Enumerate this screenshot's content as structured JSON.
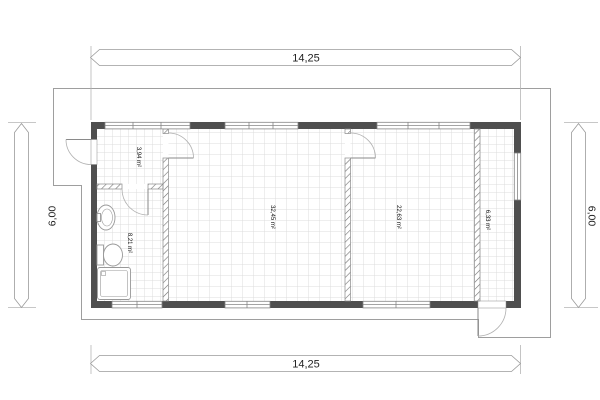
{
  "dimensions": {
    "top": "14,25",
    "bottom": "14,25",
    "left": "6,00",
    "right": "6,00"
  },
  "rooms": {
    "hall": "3,94 m²",
    "bathroom": "8,21 m²",
    "living": "32,45 m²",
    "bedroom": "22,63 m²",
    "corridor": "6,33 m²"
  },
  "colors": {
    "wall": "#4f4f4f",
    "grid": "#dcdcdc",
    "outline": "#9e9e9e",
    "fixture": "#999999",
    "door": "#a6a6a6",
    "text": "#1a1a1a"
  }
}
